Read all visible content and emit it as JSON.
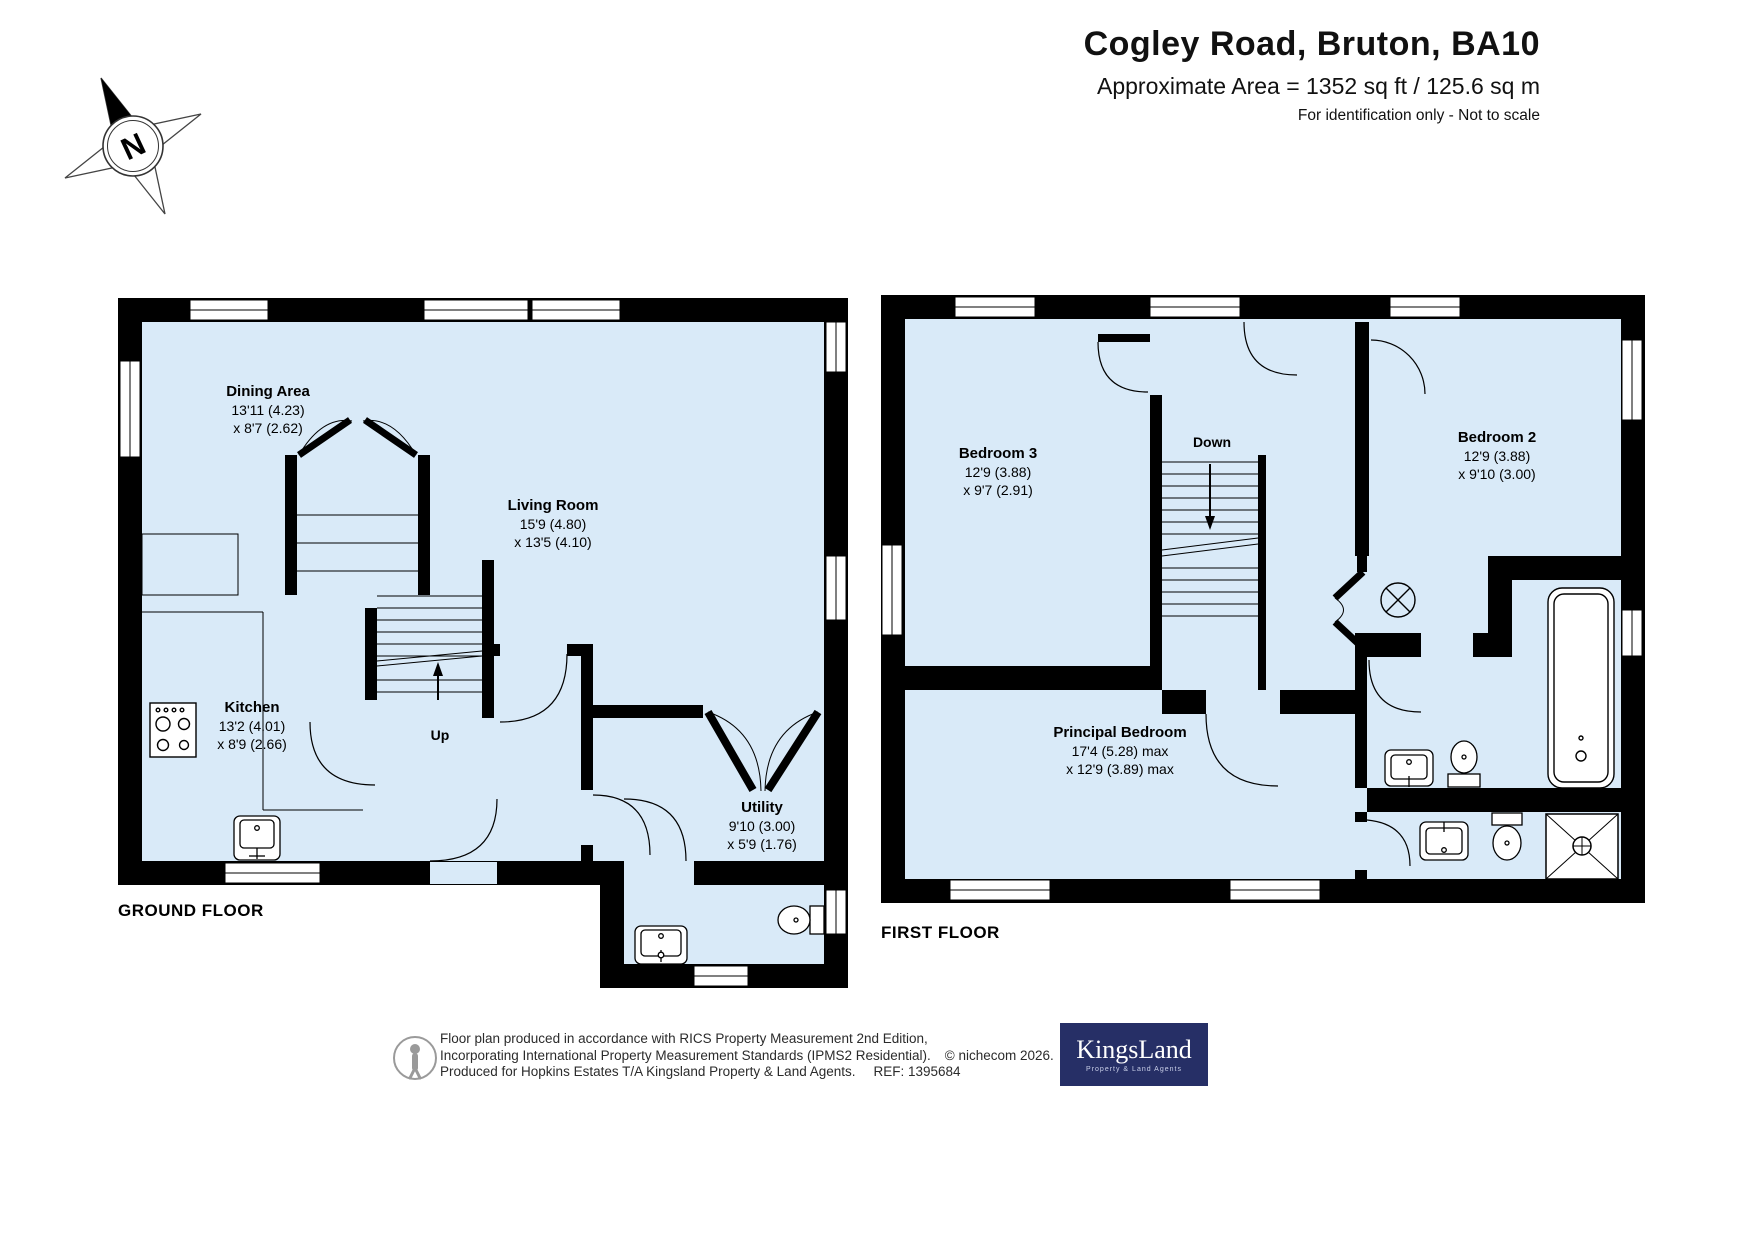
{
  "header": {
    "title": "Cogley Road, Bruton, BA10",
    "area_line": "Approximate Area = 1352 sq ft / 125.6 sq m",
    "note": "For identification only - Not to scale"
  },
  "compass": {
    "letter": "N"
  },
  "colors": {
    "floor": "#d9eaf8",
    "wall": "#000000",
    "logo_bg": "#262f66"
  },
  "plans": {
    "ground": {
      "label": "GROUND FLOOR",
      "rooms": {
        "dining": {
          "name": "Dining Area",
          "dim1": "13'11 (4.23)",
          "dim2": "x 8'7 (2.62)"
        },
        "living": {
          "name": "Living Room",
          "dim1": "15'9 (4.80)",
          "dim2": "x 13'5 (4.10)"
        },
        "kitchen": {
          "name": "Kitchen",
          "dim1": "13'2 (4.01)",
          "dim2": "x 8'9 (2.66)"
        },
        "utility": {
          "name": "Utility",
          "dim1": "9'10 (3.00)",
          "dim2": "x 5'9 (1.76)"
        },
        "stairs_label": "Up"
      }
    },
    "first": {
      "label": "FIRST FLOOR",
      "rooms": {
        "bedroom3": {
          "name": "Bedroom 3",
          "dim1": "12'9 (3.88)",
          "dim2": "x 9'7 (2.91)"
        },
        "bedroom2": {
          "name": "Bedroom 2",
          "dim1": "12'9 (3.88)",
          "dim2": "x 9'10 (3.00)"
        },
        "principal": {
          "name": "Principal Bedroom",
          "dim1": "17'4 (5.28) max",
          "dim2": "x 12'9 (3.89) max"
        },
        "stairs_label": "Down"
      }
    }
  },
  "footer": {
    "line1": "Floor plan produced in accordance with RICS Property Measurement 2nd Edition,",
    "line2": "Incorporating International Property Measurement Standards (IPMS2 Residential).",
    "copyright": "© nichecom 2026.",
    "line3": "Produced for Hopkins Estates T/A Kingsland Property & Land Agents.",
    "ref": "REF:  1395684",
    "logo": {
      "name": "KingsLand",
      "tagline": "Property & Land Agents"
    }
  }
}
